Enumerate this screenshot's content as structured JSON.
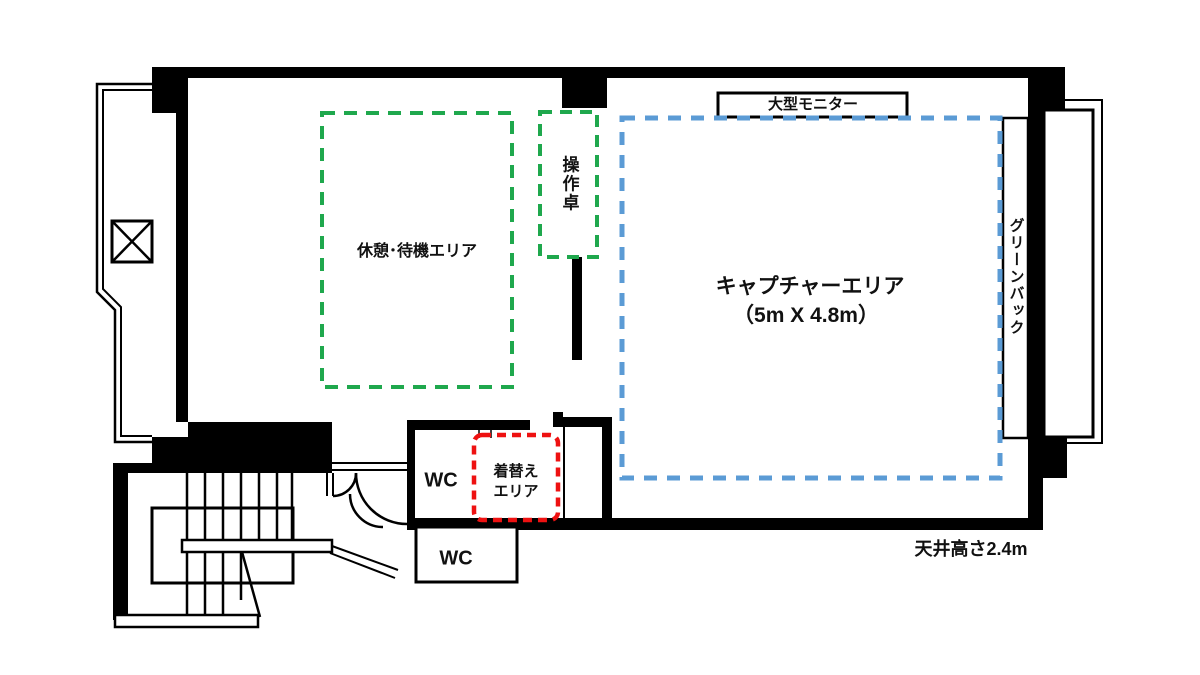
{
  "plan": {
    "areas": {
      "rest": {
        "label": "休憩･待機エリア",
        "color": "#1fa84d"
      },
      "console": {
        "label": "操作卓",
        "color": "#1fa84d"
      },
      "capture": {
        "label": "キャプチャーエリア",
        "size": "（5m X 4.8m）",
        "color": "#5b9bd5"
      },
      "changing": {
        "label": "着替え\nエリア",
        "color": "#ee1111"
      }
    },
    "fixtures": {
      "monitor": "大型モニター",
      "greenback": "グリーンバック",
      "wc_upper": "WC",
      "wc_lower": "WC",
      "elevator": "elevator-shaft",
      "stairs": "staircase"
    },
    "notes": {
      "ceiling_height": "天井高さ2.4m"
    },
    "wall_color": "#000000"
  }
}
